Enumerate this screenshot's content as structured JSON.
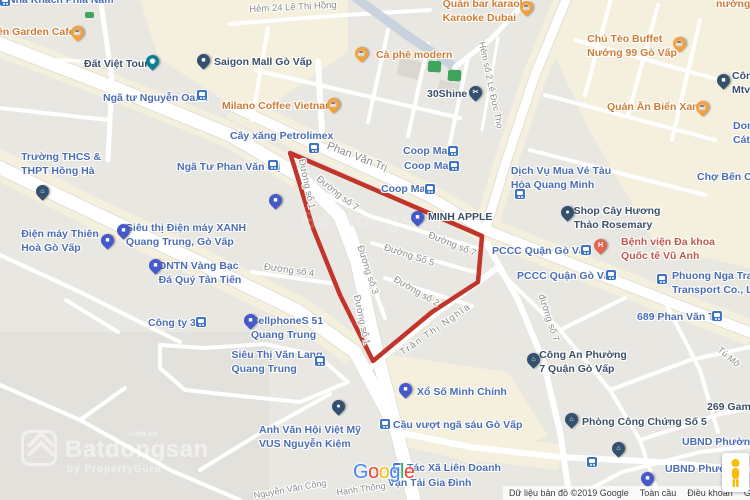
{
  "map": {
    "colors": {
      "background": "#E9E7E2",
      "commercial_area": "#F5EFDE",
      "road": "#FFFFFF",
      "road_casing": "#E2DFD8",
      "highlight_outline": "#C2352B",
      "label_blue": "#4A6DB3",
      "label_dark": "#3B5068",
      "label_food": "#CE7C35",
      "label_hospital": "#BE584A",
      "label_street": "#8C8C8C",
      "pin_orange": "#F2A13C",
      "pin_blue": "#4559C9",
      "pin_navy": "#33506F",
      "pin_teal": "#0A7F92",
      "pin_hospital": "#E2654F",
      "transit_icon_blue": "#3D74C6"
    },
    "highlight_polygon": {
      "points": [
        [
          290,
          153
        ],
        [
          482,
          236
        ],
        [
          478,
          282
        ],
        [
          432,
          312
        ],
        [
          373,
          361
        ],
        [
          340,
          295
        ],
        [
          313,
          228
        ],
        [
          296,
          172
        ]
      ],
      "stroke_width": 4.5
    },
    "labels": [
      {
        "n": "nha-khach-phia-nam",
        "x": 8,
        "y": -7,
        "a": "l",
        "cls": "blue",
        "lines": [
          "Nhà Khách Phía Nam"
        ]
      },
      {
        "n": "garden-cafe",
        "x": -3,
        "y": 25,
        "a": "l",
        "cls": "food",
        "lines": [
          "ên Garden Cafe"
        ]
      },
      {
        "n": "dat-viet-tour",
        "x": 84,
        "y": 57,
        "a": "l",
        "cls": "dark",
        "lines": [
          "Đất Việt Tour"
        ]
      },
      {
        "n": "nga-tu-nguyen-oanh",
        "x": 103,
        "y": 91,
        "a": "l",
        "cls": "blue",
        "lines": [
          "Ngã tư Nguyễn Oanh"
        ]
      },
      {
        "n": "saigon-mall-go-vap",
        "x": 214,
        "y": 55,
        "a": "l",
        "cls": "dark",
        "lines": [
          "Saigon Mall Gò Vấp"
        ]
      },
      {
        "n": "milano-coffee-vietnam",
        "x": 222,
        "y": 99,
        "a": "l",
        "cls": "food",
        "lines": [
          "Milano Coffee Vietnam"
        ]
      },
      {
        "n": "ca-phe-modern",
        "x": 376,
        "y": 48,
        "a": "l",
        "cls": "food",
        "lines": [
          "Cà phê modern"
        ]
      },
      {
        "n": "hem-24-le-thi-hong",
        "x": 293,
        "y": 8,
        "m": "cc",
        "cls": "street",
        "fs": 9.5,
        "rot": -3,
        "lines": [
          "Hẻm 24 Lê Thị Hồng"
        ]
      },
      {
        "n": "quan-bar-karaoke-dubai",
        "x": 487,
        "y": -3,
        "a": "c",
        "cls": "food",
        "lines": [
          "Quán bar karaoke",
          "Karaoke Dubai"
        ]
      },
      {
        "n": "quan-nuong",
        "x": 716,
        "y": -3,
        "a": "l",
        "cls": "food",
        "lines": [
          "nướng"
        ]
      },
      {
        "n": "chu-teo-buffet",
        "x": 632,
        "y": 32,
        "a": "c",
        "cls": "food",
        "lines": [
          "Chú Tèo Buffet",
          "Nướng 99 Gò Vấp"
        ]
      },
      {
        "n": "cong-ty-mtv",
        "x": 732,
        "y": 69,
        "a": "l",
        "cls": "dark",
        "lines": [
          "Côn",
          "Mtv"
        ]
      },
      {
        "n": "30shine",
        "x": 427,
        "y": 87,
        "a": "l",
        "cls": "dark",
        "lines": [
          "30Shine"
        ]
      },
      {
        "n": "quan-an-bien-xanh",
        "x": 607,
        "y": 100,
        "a": "l",
        "cls": "food",
        "lines": [
          "Quán Ăn Biển Xanh"
        ]
      },
      {
        "n": "cat-y",
        "x": 733,
        "y": 119,
        "a": "l",
        "cls": "blue",
        "lines": [
          "Don",
          "Cát Y"
        ]
      },
      {
        "n": "hem-so-2-le-duc-tho",
        "x": 491,
        "y": 85,
        "m": "cc",
        "cls": "street",
        "fs": 9,
        "rot": 78,
        "lines": [
          "Hẻm số 2 Lê Đức Thọ"
        ]
      },
      {
        "n": "cay-xang-petrolimex",
        "x": 230,
        "y": 129,
        "a": "l",
        "cls": "blue",
        "lines": [
          "Cây xăng Petrolimex"
        ]
      },
      {
        "n": "phan-van-tri-street",
        "x": 357,
        "y": 157,
        "m": "cc",
        "cls": "street",
        "fs": 11,
        "rot": 21,
        "lines": [
          "Phan Văn Trị"
        ]
      },
      {
        "n": "coop-mart-1",
        "x": 403,
        "y": 144,
        "a": "l",
        "cls": "blue",
        "lines": [
          "Coop Mart"
        ]
      },
      {
        "n": "coop-mart-2",
        "x": 404,
        "y": 159,
        "a": "l",
        "cls": "blue",
        "lines": [
          "Coop Mart"
        ]
      },
      {
        "n": "coop-mart-3",
        "x": 381,
        "y": 182,
        "a": "l",
        "cls": "blue",
        "lines": [
          "Coop Mart"
        ]
      },
      {
        "n": "nga-tu-phan-van-tri",
        "x": 177,
        "y": 160,
        "a": "l",
        "cls": "blue",
        "lines": [
          "Ngã Tư Phan Văn Trị"
        ]
      },
      {
        "n": "truong-thcs-thpt-hong-ha",
        "x": 61,
        "y": 150,
        "a": "c",
        "cls": "blue",
        "lines": [
          "Trường THCS &",
          "THPT Hồng Hà"
        ]
      },
      {
        "n": "cho-ben-cat",
        "x": 697,
        "y": 170,
        "a": "l",
        "cls": "blue",
        "lines": [
          "Chợ Bến Cát"
        ]
      },
      {
        "n": "dich-vu-mua-ve-tau",
        "x": 561,
        "y": 164,
        "a": "c",
        "cls": "blue",
        "lines": [
          "Dịch Vụ Mua Vé Tàu",
          "Hỏa Quang Minh"
        ]
      },
      {
        "n": "minh-apple",
        "x": 428,
        "y": 210,
        "a": "l",
        "cls": "dark",
        "lines": [
          "MINH APPLE"
        ]
      },
      {
        "n": "duong-so-7-a",
        "x": 337,
        "y": 194,
        "m": "cc",
        "cls": "street",
        "fs": 9.5,
        "rot": 38,
        "lines": [
          "Đường số 7"
        ]
      },
      {
        "n": "duong-so-7-b",
        "x": 452,
        "y": 245,
        "m": "cc",
        "cls": "street",
        "fs": 9.5,
        "rot": 22,
        "lines": [
          "Đường số 7"
        ]
      },
      {
        "n": "duong-so-7-c",
        "x": 548,
        "y": 318,
        "m": "cc",
        "cls": "street",
        "fs": 9.5,
        "rot": 72,
        "lines": [
          "đường số 7"
        ]
      },
      {
        "n": "duong-so-1-a",
        "x": 306,
        "y": 184,
        "m": "cc",
        "cls": "street",
        "fs": 9.5,
        "rot": 78,
        "lines": [
          "Đường số 1"
        ]
      },
      {
        "n": "duong-so-1-b",
        "x": 361,
        "y": 320,
        "m": "cc",
        "cls": "street",
        "fs": 9.5,
        "rot": 78,
        "lines": [
          "Đường số 1"
        ]
      },
      {
        "n": "duong-so-5",
        "x": 409,
        "y": 256,
        "m": "cc",
        "cls": "street",
        "fs": 9.5,
        "rot": 18,
        "lines": [
          "Đường Số 5"
        ]
      },
      {
        "n": "duong-so-3",
        "x": 367,
        "y": 270,
        "m": "cc",
        "cls": "street",
        "fs": 9.5,
        "rot": 72,
        "lines": [
          "Đường số 3"
        ]
      },
      {
        "n": "duong-so-2",
        "x": 416,
        "y": 292,
        "m": "cc",
        "cls": "street",
        "fs": 9.5,
        "rot": 30,
        "lines": [
          "Đường số 2"
        ]
      },
      {
        "n": "duong-so-4",
        "x": 289,
        "y": 271,
        "m": "cc",
        "cls": "street",
        "fs": 9.5,
        "rot": 8,
        "lines": [
          "Đường số 4"
        ]
      },
      {
        "n": "tran-thi-nghia",
        "x": 436,
        "y": 330,
        "m": "cc",
        "cls": "street",
        "fs": 9.5,
        "rot": -35,
        "ls": 1.5,
        "lines": [
          "Trần Thị Nghĩa"
        ]
      },
      {
        "n": "shop-cay-huong-thao",
        "x": 617,
        "y": 204,
        "a": "c",
        "cls": "dark",
        "lines": [
          "Shop Cây Hương",
          "Thảo Rosemary"
        ]
      },
      {
        "n": "benh-vien-vu-anh",
        "x": 668,
        "y": 235,
        "a": "c",
        "cls": "hosp",
        "lines": [
          "Bệnh viện Đa khoa",
          "Quốc tế Vũ Anh"
        ]
      },
      {
        "n": "pccc-quan-go-vap-1",
        "x": 492,
        "y": 244,
        "a": "l",
        "cls": "blue",
        "lines": [
          "PCCC Quận Gò Vấp"
        ]
      },
      {
        "n": "pccc-quan-go-vap-2",
        "x": 517,
        "y": 269,
        "a": "l",
        "cls": "blue",
        "lines": [
          "PCCC Quận Gò Vấp"
        ]
      },
      {
        "n": "phuong-nga-transport",
        "x": 672,
        "y": 269,
        "a": "l",
        "cls": "blue",
        "lines": [
          "Phuong Nga Trad",
          "Transport Co., Ltd"
        ]
      },
      {
        "n": "689-phan-van-tri",
        "x": 637,
        "y": 310,
        "a": "l",
        "cls": "blue",
        "lines": [
          "689 Phan Văn Trị"
        ]
      },
      {
        "n": "dien-may-thien-hoa",
        "x": 60,
        "y": 227,
        "a": "c",
        "cls": "blue",
        "lines": [
          "Điện máy Thiên",
          "Hoà Gò Vấp"
        ]
      },
      {
        "n": "dien-may-xanh",
        "x": 186,
        "y": 221,
        "a": "c",
        "cls": "blue",
        "lines": [
          "Siêu thị Điện máy XANH",
          "Quang Trung, Gò Vấp"
        ]
      },
      {
        "n": "dntn-tan-tien",
        "x": 200,
        "y": 259,
        "a": "c",
        "cls": "blue",
        "lines": [
          "DNTN Vàng Bạc",
          "Đá Quý Tân Tiến"
        ]
      },
      {
        "n": "cong-ty-32",
        "x": 148,
        "y": 316,
        "a": "l",
        "cls": "blue",
        "lines": [
          "Công ty 32"
        ]
      },
      {
        "n": "cellphones-51",
        "x": 287,
        "y": 314,
        "a": "c",
        "cls": "blue",
        "lines": [
          "CellphoneS 51",
          "Quang Trung"
        ]
      },
      {
        "n": "sieu-thi-van-lang",
        "x": 277,
        "y": 348,
        "a": "c",
        "cls": "blue",
        "lines": [
          "Siêu Thị Văn Lang",
          "Quang Trung"
        ]
      },
      {
        "n": "cong-an-phuong-7",
        "x": 583,
        "y": 348,
        "a": "c",
        "cls": "dark",
        "lines": [
          "Công An Phường",
          "7 Quận Gò Vấp"
        ]
      },
      {
        "n": "tu-mo",
        "x": 729,
        "y": 357,
        "m": "cc",
        "cls": "street",
        "fs": 9,
        "rot": 40,
        "lines": [
          "Tú Mỡ"
        ]
      },
      {
        "n": "vus-nguyen-kiem",
        "x": 310,
        "y": 423,
        "a": "c",
        "cls": "blue",
        "lines": [
          "Anh Văn Hội Việt Mỹ",
          "VUS Nguyễn Kiệm"
        ]
      },
      {
        "n": "xo-so-minh-chinh",
        "x": 417,
        "y": 385,
        "a": "l",
        "cls": "blue",
        "lines": [
          "Xổ Số Minh Chính"
        ]
      },
      {
        "n": "cau-vuot-nga-sau",
        "x": 393,
        "y": 418,
        "a": "l",
        "cls": "blue",
        "lines": [
          "Cầu vượt ngã sáu Gò Vấp"
        ]
      },
      {
        "n": "phong-cong-chung-so-5",
        "x": 582,
        "y": 415,
        "a": "l",
        "cls": "dark",
        "lines": [
          "Phòng Công Chứng Số 5"
        ]
      },
      {
        "n": "269-gami",
        "x": 707,
        "y": 400,
        "a": "l",
        "cls": "dark",
        "lines": [
          "269 Gami"
        ]
      },
      {
        "n": "ubnd-phuong-5",
        "x": 682,
        "y": 435,
        "a": "l",
        "cls": "blue",
        "lines": [
          "UBND Phường 5"
        ]
      },
      {
        "n": "ubnd-phuong",
        "x": 665,
        "y": 462,
        "a": "l",
        "cls": "blue",
        "lines": [
          "UBND Phường"
        ]
      },
      {
        "n": "hop-tac-xa-lien-doanh",
        "x": 407,
        "y": 461,
        "a": "l",
        "cls": "blue",
        "lines": [
          "Tác Xã Liên Doanh"
        ]
      },
      {
        "n": "van-tai-gia-dinh",
        "x": 388,
        "y": 476,
        "a": "l",
        "cls": "blue",
        "lines": [
          "Vận Tải Gia Đình"
        ]
      },
      {
        "n": "nguyen-van-cong",
        "x": 290,
        "y": 489,
        "m": "cc",
        "cls": "street",
        "fs": 9,
        "rot": -10,
        "lines": [
          "Nguyễn Văn Công"
        ]
      },
      {
        "n": "hanh-thong",
        "x": 361,
        "y": 489,
        "m": "cc",
        "cls": "street",
        "fs": 9,
        "rot": -8,
        "lines": [
          "Hạnh Thông"
        ]
      }
    ],
    "pins": [
      {
        "n": "pin-garden-cafe",
        "x": 77,
        "y": 32,
        "c": "orange",
        "g": "☕"
      },
      {
        "n": "pin-ca-phe-modern",
        "x": 361,
        "y": 53,
        "c": "orange",
        "g": "☕"
      },
      {
        "n": "pin-milano-coffee",
        "x": 333,
        "y": 104,
        "c": "orange",
        "g": "☕"
      },
      {
        "n": "pin-karaoke-dubai",
        "x": 526,
        "y": 7,
        "c": "orange",
        "g": "☕"
      },
      {
        "n": "pin-chu-teo-buffet",
        "x": 679,
        "y": 43,
        "c": "orange",
        "g": "☕"
      },
      {
        "n": "pin-quan-an-bien-xanh",
        "x": 702,
        "y": 107,
        "c": "orange",
        "g": "☕"
      },
      {
        "n": "pin-dat-viet-tour",
        "x": 152,
        "y": 61,
        "c": "teal",
        "g": "◉"
      },
      {
        "n": "pin-saigon-mall",
        "x": 203,
        "y": 60,
        "c": "navy",
        "g": "■"
      },
      {
        "n": "pin-30shine",
        "x": 475,
        "y": 92,
        "c": "navy",
        "g": "✂"
      },
      {
        "n": "pin-hong-ha-school",
        "x": 42,
        "y": 191,
        "c": "navy",
        "g": "⌂"
      },
      {
        "n": "pin-rosemary-shop",
        "x": 567,
        "y": 212,
        "c": "navy",
        "g": "●"
      },
      {
        "n": "pin-cong-an-phuong-7",
        "x": 533,
        "y": 359,
        "c": "navy",
        "g": "⌂"
      },
      {
        "n": "pin-phong-cong-chung",
        "x": 571,
        "y": 419,
        "c": "navy",
        "g": "⌂"
      },
      {
        "n": "pin-school-2",
        "x": 618,
        "y": 448,
        "c": "navy",
        "g": "⌂"
      },
      {
        "n": "pin-vus",
        "x": 338,
        "y": 406,
        "c": "navy",
        "g": "●"
      },
      {
        "n": "pin-cong-ty-mtv",
        "x": 723,
        "y": 80,
        "c": "navy",
        "g": "■"
      },
      {
        "n": "pin-minh-apple",
        "x": 417,
        "y": 217,
        "c": "blue",
        "g": "■"
      },
      {
        "n": "pin-shop-pvt",
        "x": 275,
        "y": 200,
        "c": "blue",
        "g": "■"
      },
      {
        "n": "pin-dien-may-thien-hoa",
        "x": 107,
        "y": 240,
        "c": "blue",
        "g": "■"
      },
      {
        "n": "pin-dien-may-xanh",
        "x": 123,
        "y": 230,
        "c": "blue",
        "g": "■"
      },
      {
        "n": "pin-dntn-tan-tien",
        "x": 155,
        "y": 265,
        "c": "blue",
        "g": "■"
      },
      {
        "n": "pin-cellphones",
        "x": 250,
        "y": 320,
        "c": "blue",
        "g": "■"
      },
      {
        "n": "pin-xo-so-minh-chinh",
        "x": 405,
        "y": 389,
        "c": "blue",
        "g": "■"
      },
      {
        "n": "pin-ubnd",
        "x": 647,
        "y": 478,
        "c": "blue",
        "g": "■"
      },
      {
        "n": "pin-benh-vien-vu-anh",
        "x": 600,
        "y": 245,
        "c": "hosp",
        "g": "H"
      }
    ],
    "transit_icons": [
      {
        "x": 0,
        "y": -4
      },
      {
        "x": 197,
        "y": 90
      },
      {
        "x": 268,
        "y": 160
      },
      {
        "x": 309,
        "y": 143
      },
      {
        "x": 448,
        "y": 146
      },
      {
        "x": 449,
        "y": 161
      },
      {
        "x": 425,
        "y": 184
      },
      {
        "x": 515,
        "y": 189
      },
      {
        "x": 581,
        "y": 245
      },
      {
        "x": 606,
        "y": 270
      },
      {
        "x": 657,
        "y": 274
      },
      {
        "x": 712,
        "y": 311
      },
      {
        "x": 196,
        "y": 317
      },
      {
        "x": 315,
        "y": 356
      },
      {
        "x": 380,
        "y": 419
      },
      {
        "x": 393,
        "y": 463
      },
      {
        "x": 587,
        "y": 457
      }
    ],
    "green_markers": [
      [
        85,
        12,
        9,
        6
      ],
      [
        428,
        61,
        13,
        11
      ],
      [
        448,
        70,
        13,
        11
      ]
    ]
  },
  "watermark": {
    "brand": "Batdongsan",
    "domain": ".com.vn",
    "byline": "by PropertyGuru"
  },
  "watermark_faint": "Batdongsan",
  "google_logo": {
    "letters": [
      "G",
      "o",
      "o",
      "g",
      "l",
      "e"
    ],
    "colors": [
      "#4285F4",
      "#EA4335",
      "#FBBC05",
      "#4285F4",
      "#34A853",
      "#EA4335"
    ]
  },
  "attribution": {
    "map_data": "Dữ liệu bản đồ ©2019 Google",
    "links": [
      "Toàn cầu",
      "Điều khoản",
      "Gửi phản hồi"
    ]
  }
}
